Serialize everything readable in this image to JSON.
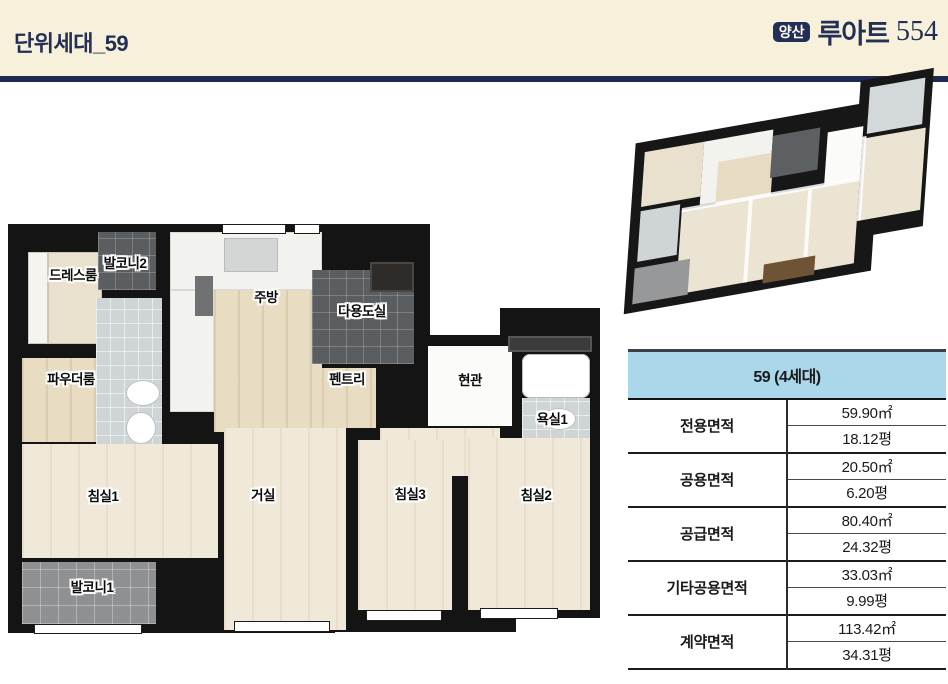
{
  "header": {
    "title": "단위세대_59",
    "logo": {
      "badge": "양산",
      "name": "루아트",
      "number": "554"
    },
    "colors": {
      "background": "#f7f1dc",
      "navy": "#232f55"
    }
  },
  "floorplan": {
    "rooms": [
      {
        "id": "balcony-2",
        "label": "발코니2"
      },
      {
        "id": "dress-room",
        "label": "드레스룸"
      },
      {
        "id": "kitchen",
        "label": "주방"
      },
      {
        "id": "utility",
        "label": "다용도실"
      },
      {
        "id": "powder-room",
        "label": "파우더룸"
      },
      {
        "id": "pantry",
        "label": "펜트리"
      },
      {
        "id": "entrance",
        "label": "현관"
      },
      {
        "id": "bathroom-1",
        "label": "욕실1"
      },
      {
        "id": "bedroom-1",
        "label": "침실1"
      },
      {
        "id": "living-room",
        "label": "거실"
      },
      {
        "id": "bedroom-3",
        "label": "침실3"
      },
      {
        "id": "bedroom-2",
        "label": "침실2"
      },
      {
        "id": "balcony-1",
        "label": "발코니1"
      }
    ]
  },
  "table": {
    "header": "59 (4세대)",
    "header_bg": "#abd7eb",
    "rows": [
      {
        "label": "전용면적",
        "sqm": "59.90㎡",
        "pyeong": "18.12평"
      },
      {
        "label": "공용면적",
        "sqm": "20.50㎡",
        "pyeong": "6.20평"
      },
      {
        "label": "공급면적",
        "sqm": "80.40㎡",
        "pyeong": "24.32평"
      },
      {
        "label": "기타공용면적",
        "sqm": "33.03㎡",
        "pyeong": "9.99평"
      },
      {
        "label": "계약면적",
        "sqm": "113.42㎡",
        "pyeong": "34.31평"
      }
    ]
  }
}
